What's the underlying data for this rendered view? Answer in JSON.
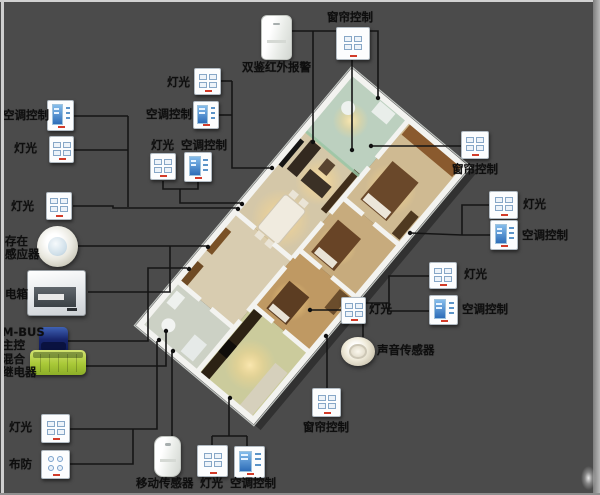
{
  "canvas": {
    "background_color": "#4b4b4b",
    "wire_color": "#151515",
    "label_text_color": "#0e0e0e",
    "switch_screen_blue": "#2e6db8",
    "relay_green": "#a9c938",
    "mbus_blue": "#17256c"
  },
  "floor_plan": {
    "style": "3d-apartment-render",
    "wall_color": "#f3f3f0",
    "floor_beige": "#d5c8aa",
    "glass_green": "#9cc7a6"
  },
  "devices": [
    {
      "name": "curtain-control-top",
      "label": "窗帘控制",
      "type": "switch4",
      "icon": "curtain-switch-panel-icon",
      "icon_box": [
        336,
        27,
        34,
        33
      ],
      "label_box": [
        327,
        11
      ]
    },
    {
      "name": "dual-infrared-alarm",
      "label": "双鉴红外报警",
      "type": "pir",
      "icon": "infrared-detector-icon",
      "icon_box": [
        261,
        15,
        31,
        45
      ],
      "label_box": [
        242,
        61
      ]
    },
    {
      "name": "ac-control-top-left",
      "label": "空调控制",
      "type": "ac",
      "icon": "ac-control-panel-icon",
      "icon_box": [
        47,
        100,
        27,
        31
      ],
      "label_box": [
        3,
        109
      ]
    },
    {
      "name": "light-top-left-1",
      "label": "灯光",
      "type": "switch4",
      "icon": "light-switch-panel-icon",
      "icon_box": [
        49,
        136,
        25,
        27
      ],
      "label_box": [
        14,
        142
      ]
    },
    {
      "name": "light-top-left-2",
      "label": "灯光",
      "type": "switch4",
      "icon": "light-switch-panel-icon",
      "icon_box": [
        46,
        192,
        26,
        28
      ],
      "label_box": [
        11,
        200
      ]
    },
    {
      "name": "light-top-center",
      "label": "灯光",
      "type": "switch4",
      "icon": "light-switch-panel-icon",
      "icon_box": [
        194,
        68,
        27,
        27
      ],
      "label_box": [
        167,
        76
      ]
    },
    {
      "name": "ac-control-top-center",
      "label": "空调控制",
      "type": "ac",
      "icon": "ac-control-panel-icon",
      "icon_box": [
        193,
        101,
        26,
        28
      ],
      "label_box": [
        146,
        108
      ]
    },
    {
      "name": "light-center",
      "label": "灯光",
      "type": "switch4",
      "icon": "light-switch-panel-icon",
      "icon_box": [
        150,
        153,
        26,
        27
      ],
      "label_box": [
        151,
        139
      ]
    },
    {
      "name": "ac-control-center",
      "label": "空调控制",
      "type": "ac",
      "icon": "ac-control-panel-icon",
      "icon_box": [
        184,
        152,
        28,
        30
      ],
      "label_box": [
        181,
        139
      ]
    },
    {
      "name": "curtain-control-right",
      "label": "窗帘控制",
      "type": "switch4",
      "icon": "curtain-switch-panel-icon",
      "icon_box": [
        461,
        131,
        28,
        28
      ],
      "label_box": [
        452,
        163
      ]
    },
    {
      "name": "light-right",
      "label": "灯光",
      "type": "switch4",
      "icon": "light-switch-panel-icon",
      "icon_box": [
        489,
        191,
        29,
        28
      ],
      "label_box": [
        523,
        198
      ]
    },
    {
      "name": "ac-control-right",
      "label": "空调控制",
      "type": "ac",
      "icon": "ac-control-panel-icon",
      "icon_box": [
        490,
        220,
        28,
        30
      ],
      "label_box": [
        522,
        229
      ]
    },
    {
      "name": "light-right-lower",
      "label": "灯光",
      "type": "switch4",
      "icon": "light-switch-panel-icon",
      "icon_box": [
        429,
        262,
        28,
        27
      ],
      "label_box": [
        464,
        268
      ]
    },
    {
      "name": "ac-control-right-lower",
      "label": "空调控制",
      "type": "ac",
      "icon": "ac-control-panel-icon",
      "icon_box": [
        429,
        295,
        29,
        30
      ],
      "label_box": [
        462,
        303
      ]
    },
    {
      "name": "light-inner",
      "label": "灯光",
      "type": "switch4",
      "icon": "light-switch-panel-icon",
      "icon_box": [
        341,
        297,
        25,
        27
      ],
      "label_box": [
        369,
        303
      ]
    },
    {
      "name": "sound-sensor",
      "label": "声音传感器",
      "type": "sound",
      "icon": "sound-sensor-icon",
      "icon_box": [
        341,
        337,
        34,
        29
      ],
      "label_box": [
        377,
        344
      ]
    },
    {
      "name": "curtain-control-bottom",
      "label": "窗帘控制",
      "type": "switch4",
      "icon": "curtain-switch-panel-icon",
      "icon_box": [
        312,
        388,
        29,
        29
      ],
      "label_box": [
        303,
        421
      ]
    },
    {
      "name": "presence-sensor",
      "label": "存在感应器",
      "lines": [
        "存在",
        "感应器"
      ],
      "type": "dome",
      "icon": "presence-sensor-icon",
      "icon_box": [
        37,
        226,
        41,
        41
      ],
      "label_box": [
        5,
        235
      ]
    },
    {
      "name": "electrical-box",
      "label": "电箱",
      "type": "ebox",
      "icon": "electrical-box-icon",
      "icon_box": [
        27,
        270,
        59,
        46
      ],
      "label_box": [
        5,
        288
      ]
    },
    {
      "name": "mbus-master",
      "label": "M-BUS 主控",
      "lines": [
        "M-BUS",
        "主控"
      ],
      "type": "mbus",
      "icon": "bus-controller-icon",
      "icon_box": [
        39,
        327,
        29,
        28
      ],
      "label_box": [
        2,
        326
      ]
    },
    {
      "name": "hybrid-relay",
      "label": "混合继电器",
      "lines": [
        "混合",
        "继电器"
      ],
      "type": "relay",
      "icon": "relay-module-icon",
      "icon_box": [
        30,
        350,
        56,
        25
      ],
      "label_box": [
        2,
        353
      ]
    },
    {
      "name": "light-bottom-left",
      "label": "灯光",
      "type": "switch4",
      "icon": "light-switch-panel-icon",
      "icon_box": [
        41,
        414,
        29,
        29
      ],
      "label_box": [
        9,
        421
      ]
    },
    {
      "name": "arming-switch",
      "label": "布防",
      "type": "scene",
      "icon": "arming-switch-panel-icon",
      "icon_box": [
        41,
        450,
        29,
        29
      ],
      "label_box": [
        9,
        458
      ]
    },
    {
      "name": "motion-sensor",
      "label": "移动传感器",
      "type": "pir2",
      "icon": "motion-sensor-icon",
      "icon_box": [
        154,
        436,
        27,
        41
      ],
      "label_box": [
        136,
        477
      ]
    },
    {
      "name": "light-bottom",
      "label": "灯光",
      "type": "switch4",
      "icon": "light-switch-panel-icon",
      "icon_box": [
        197,
        445,
        31,
        32
      ],
      "label_box": [
        200,
        477
      ]
    },
    {
      "name": "ac-control-bottom",
      "label": "空调控制",
      "type": "ac",
      "icon": "ac-control-panel-icon",
      "icon_box": [
        234,
        446,
        31,
        32
      ],
      "label_box": [
        230,
        477
      ]
    }
  ]
}
